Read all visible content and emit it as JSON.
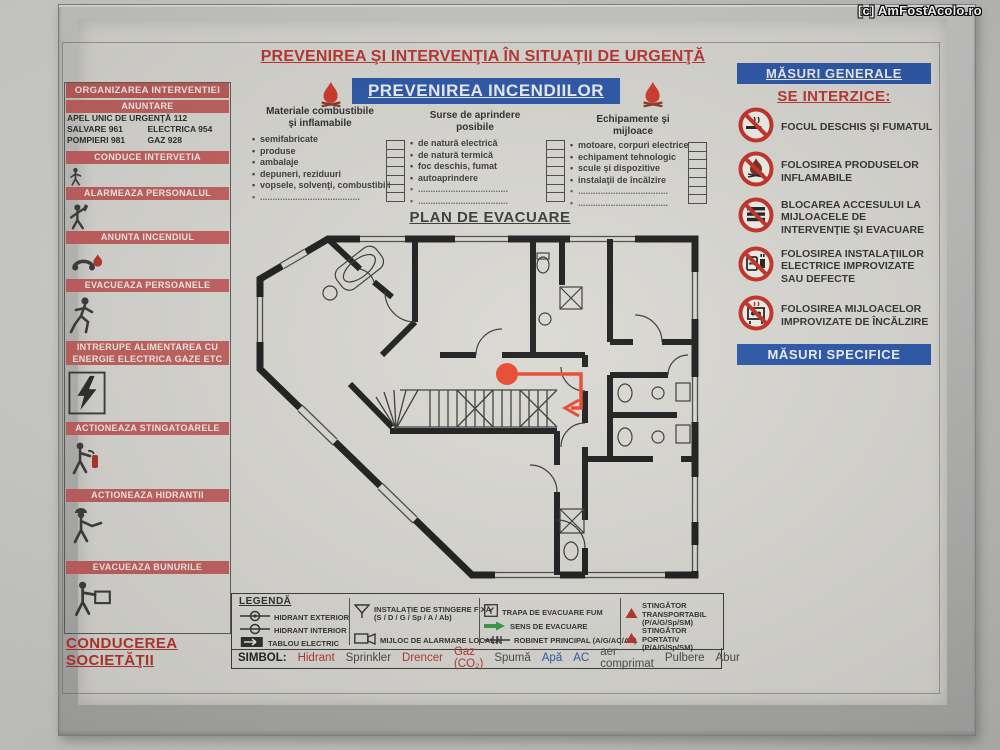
{
  "watermark": {
    "text": "[c] AmFostAcolo.ro"
  },
  "header": {
    "title": "PREVENIREA ŞI INTERVENŢIA ÎN SITUAŢII DE URGENŢĂ",
    "subtitle": "PREVENIREA INCENDIILOR"
  },
  "sidebar": {
    "title": "ORGANIZAREA INTERVENTIEI",
    "anuntare_label": "ANUNTARE",
    "phones": {
      "emergency": "APEL UNIC DE URGENŢĂ 112",
      "items": [
        "SALVARE  961",
        "ELECTRICA  954",
        "POMPIERI  981",
        "GAZ  928"
      ]
    },
    "steps": [
      {
        "label": "CONDUCE INTERVETIA",
        "icon": "person-directing-icon"
      },
      {
        "label": "ALARMEAZA PERSONALUL",
        "icon": "person-at-phone-icon"
      },
      {
        "label": "ANUNTA INCENDIUL",
        "icon": "phone-flame-icon"
      },
      {
        "label": "EVACUEAZA PERSOANELE",
        "icon": "running-person-icon"
      },
      {
        "label": "INTRERUPE ALIMENTAREA CU\nENERGIE ELECTRICA  GAZE ETC",
        "icon": "lightning-icon"
      },
      {
        "label": "ACTIONEAZA STINGATOARELE",
        "icon": "person-extinguisher-icon"
      },
      {
        "label": "ACTIONEAZA HIDRANTII",
        "icon": "firefighter-icon"
      },
      {
        "label": "EVACUEAZA BUNURILE MATERIALE",
        "icon": "person-carrying-box-icon"
      }
    ],
    "footer": "CONDUCEREA SOCIETĂŢII"
  },
  "prevention": {
    "columns": [
      {
        "title": "Materiale combustibile\nşi inflamabile",
        "items": [
          "semifabricate",
          "produse",
          "ambalaje",
          "depuneri, reziduuri",
          "vopsele, solvenţi, combustibili",
          "........................................"
        ]
      },
      {
        "title": "Surse de aprindere\nposibile",
        "items": [
          "de natură electrică",
          "de natură termică",
          "foc deschis, fumat",
          "autoaprindere",
          "....................................",
          "...................................."
        ]
      },
      {
        "title": "Echipamente şi\nmijloace",
        "items": [
          "motoare, corpuri electrice",
          "echipament tehnologic",
          "scule şi dispozitive",
          "instalaţii de încălzire",
          "....................................",
          "...................................."
        ]
      }
    ]
  },
  "plan": {
    "title": "PLAN DE EVACUARE"
  },
  "measures": {
    "general_title": "MĂSURI GENERALE",
    "prohibition_heading": "SE INTERZICE:",
    "items": [
      {
        "label": "FOCUL DESCHIS ŞI FUMATUL",
        "icon": "no-open-fire-smoking-icon"
      },
      {
        "label": "FOLOSIREA PRODUSELOR INFLAMABILE",
        "icon": "no-flammable-products-icon"
      },
      {
        "label": "BLOCAREA ACCESULUI LA MIJLOACELE DE INTERVENŢIE ŞI EVACUARE",
        "icon": "no-blocking-access-icon"
      },
      {
        "label": "FOLOSIREA INSTALAŢIILOR ELECTRICE IMPROVIZATE SAU DEFECTE",
        "icon": "no-improvised-electric-icon"
      },
      {
        "label": "FOLOSIREA MIJLOACELOR IMPROVIZATE DE ÎNCĂLZIRE",
        "icon": "no-improvised-heating-icon"
      }
    ],
    "specific_title": "MĂSURI SPECIFICE"
  },
  "legend": {
    "title": "LEGENDĂ",
    "items": [
      {
        "label": "HIDRANT EXTERIOR",
        "icon": "hydrant-exterior-icon"
      },
      {
        "label": "HIDRANT INTERIOR",
        "icon": "hydrant-interior-icon"
      },
      {
        "label": "TABLOU ELECTRIC",
        "icon": "electric-panel-icon"
      },
      {
        "label": "INSTALAŢIE DE STINGERE FIXĂ\n(S / D / G / Sp / A / Ab)",
        "icon": "fixed-extinguishing-icon"
      },
      {
        "label": "MIJLOC DE ALARMARE LOCALĂ",
        "icon": "local-alarm-icon"
      },
      {
        "label": "TRAPA DE EVACUARE FUM",
        "icon": "smoke-hatch-icon"
      },
      {
        "label": "SENS DE EVACUARE",
        "icon": "evacuation-direction-icon"
      },
      {
        "label": "ROBINET PRINCIPAL (A/G/AC/Ab)",
        "icon": "main-valve-icon"
      },
      {
        "label": "STINGĂTOR TRANSPORTABIL\n(P/A/G/Sp/SM)",
        "icon": "wheeled-extinguisher-icon"
      },
      {
        "label": "STINGĂTOR PORTATIV\n(P/A/G/Sp/SM)",
        "icon": "portable-extinguisher-icon"
      }
    ],
    "symbol_label": "SIMBOL:",
    "symbols": [
      "Hidrant",
      "Sprinkler",
      "Drencer",
      "Gaz (CO₂)",
      "Spumă",
      "Apă",
      "AC",
      "aer comprimat",
      "Pulbere",
      "Abur"
    ]
  },
  "colors": {
    "bar_red": "#c2605f",
    "title_red": "#bb3530",
    "banner_blue": "#2b57a8",
    "prohibition_red": "#c23127",
    "evacuation_marker_red": "#e8482e",
    "evacuation_arrow_green": "#3a9a4a"
  }
}
